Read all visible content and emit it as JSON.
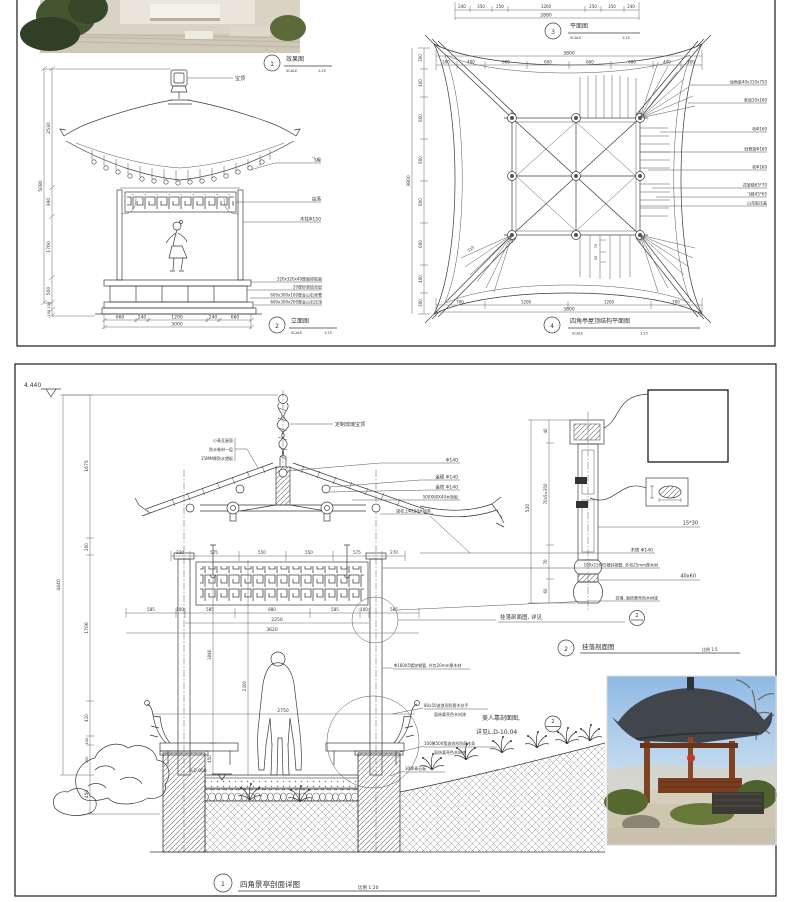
{
  "colors": {
    "line": "#3a3a3a",
    "paper": "#ffffff",
    "panel_border": "#1a1a1a",
    "photo_sky": "#9ec3e8",
    "roof_dark": "#41464d",
    "wood": "#7d4322",
    "foliage": "#4e6230"
  },
  "top": {
    "c1": {
      "num": "1",
      "title": "效果图",
      "scale_l": "SCALE",
      "scale_v": "1:25"
    },
    "elev": {
      "c": {
        "num": "2",
        "title": "立面图",
        "scale_l": "SCALE",
        "scale_v": "1:25"
      },
      "left": [
        "2530",
        "390",
        "1760",
        "500",
        "150",
        "100"
      ],
      "left_total": "5080",
      "bottom": [
        "660",
        "240",
        "1200",
        "240",
        "660"
      ],
      "bottom_total": "3000",
      "r": [
        "宝顶",
        "飞椽",
        "挂落",
        "木柱Φ150",
        "320x320x40厚面砖贴面",
        "20厚砂浆结合层",
        "600x300x100厚金山石坐凳",
        "600x300x200厚金山石压顶"
      ]
    },
    "plan3": {
      "c": {
        "num": "3",
        "title": "平面图",
        "scale_l": "SCALE",
        "scale_v": "1:25"
      },
      "dims": [
        "240",
        "350",
        "250",
        "1200",
        "250",
        "350",
        "240"
      ],
      "total": "2880"
    },
    "roof": {
      "c": {
        "num": "4",
        "title": "四角亭屋顶结构平面图",
        "scale_l": "SCALE",
        "scale_v": "1:25"
      },
      "top": [
        "300",
        "400",
        "600",
        "600",
        "600",
        "600",
        "400",
        "300"
      ],
      "top_total": "3800",
      "left": [
        "300",
        "400",
        "600",
        "600",
        "600",
        "600",
        "400",
        "300"
      ],
      "left_total": "3800",
      "bottom": [
        "700",
        "1200",
        "1200",
        "700"
      ],
      "bottom_total": "3800",
      "r": [
        "戗角梁40x310x750",
        "老戗30x160",
        "桁Φ160",
        "戗脊梁Φ160",
        "枋Φ160",
        "花架椽65*70",
        "飞椽45*65",
        "山花板压盖"
      ],
      "diag": "715",
      "d70": "70",
      "d50": "50"
    }
  },
  "bottom": {
    "level": "4.440",
    "sec": {
      "c": {
        "num": "1",
        "title": "四角景亭剖面详图",
        "scale": "比例 1:20"
      },
      "left": [
        "1675",
        "200",
        "1706",
        "410",
        "100",
        "350",
        "450"
      ],
      "left_total": "4440",
      "roof_l": [
        "小青瓦屋面",
        "防水卷材一层",
        "15MM厚防水望板"
      ],
      "finial": "定制琉璃宝顶",
      "r1": [
        "Φ140",
        "金檩 Φ140",
        "金枋 Φ140",
        "500X60X40木垫板",
        "梁枋上Φ120木檩条"
      ],
      "r2": [
        "木枋 Φ140",
        "100x150X5镀锌钢管, 外包25mm厚木材",
        "挂落, 面饰栗壳色木材漆"
      ],
      "ref1": {
        "t": "挂落剖面图, 详见",
        "n": "2"
      },
      "steel": "Φ160X5镀锌钢管, 外包20mm厚木材",
      "stone": "30厚青石板",
      "bench": [
        "80x50波浪形防腐木扶手",
        "面饰栗壳色木材漆",
        "100厚500宽波浪形防腐木条",
        "面饰栗壳色木材漆"
      ],
      "ref2": {
        "t1": "美人靠剖面图,",
        "t2": "详见L.D-10.04",
        "n": "2"
      },
      "htop": [
        "220",
        "575",
        "550",
        "550",
        "575",
        "270"
      ],
      "hmid": [
        "585",
        "100",
        "585",
        "880",
        "585",
        "100",
        "585"
      ],
      "h2250": "2250",
      "h3620": "3620",
      "v1846": "1846",
      "v2300": "2300",
      "v450": "450",
      "h2750": "2750",
      "zero": "±0.000"
    },
    "det": {
      "c": {
        "num": "2",
        "title": "挂落剖面图",
        "scale": "比例 1:5"
      },
      "left": [
        "40",
        "70x5=350",
        "70",
        "60"
      ],
      "total": "520",
      "l1": "15*30",
      "l2": "40x60"
    }
  }
}
